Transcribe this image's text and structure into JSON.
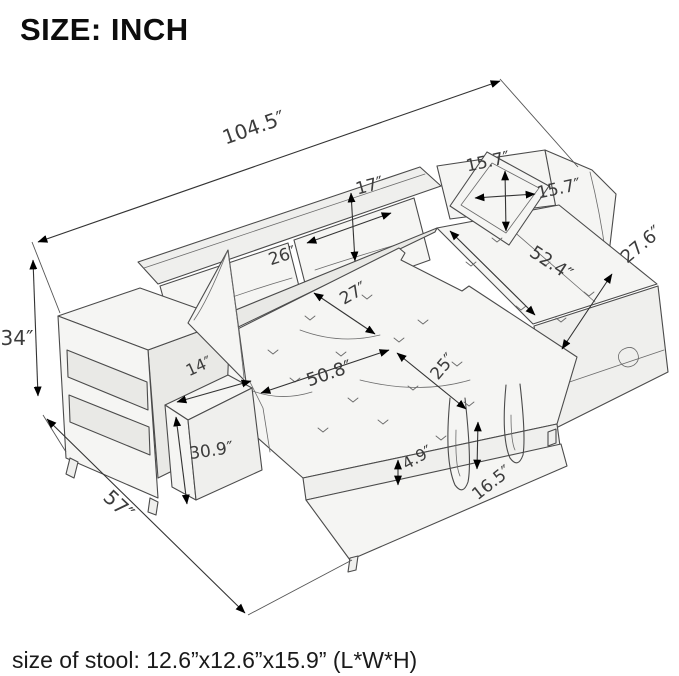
{
  "title": "SIZE: INCH",
  "caption": "size of stool: 12.6”x12.6”x15.9” (L*W*H)",
  "unit": "INCH",
  "dimensions": {
    "overall_width": "104.5″",
    "overall_height": "34″",
    "overall_depth": "57″",
    "back_cushion_height": "17″",
    "back_cushion_width": "26″",
    "pillow_height": "15.7″",
    "pillow_width": "15.7″",
    "chaise_length": "52.4″",
    "chaise_width": "27.6″",
    "seat_depth": "27″",
    "bed_length": "50.8″",
    "bed_width": "25″",
    "mattress_thickness": "4.9″",
    "bed_floor_height": "16.5″",
    "arm_top_width": "14″",
    "arm_front_height": "30.9″"
  },
  "colors": {
    "line": "#4b4b4b",
    "label": "#3c3c3c",
    "title": "#0d0d0d",
    "caption": "#1a1a1a",
    "fillA": "#f5f5f3",
    "fillB": "#efefed",
    "fillC": "#e9e9e6",
    "bg": "#ffffff"
  }
}
